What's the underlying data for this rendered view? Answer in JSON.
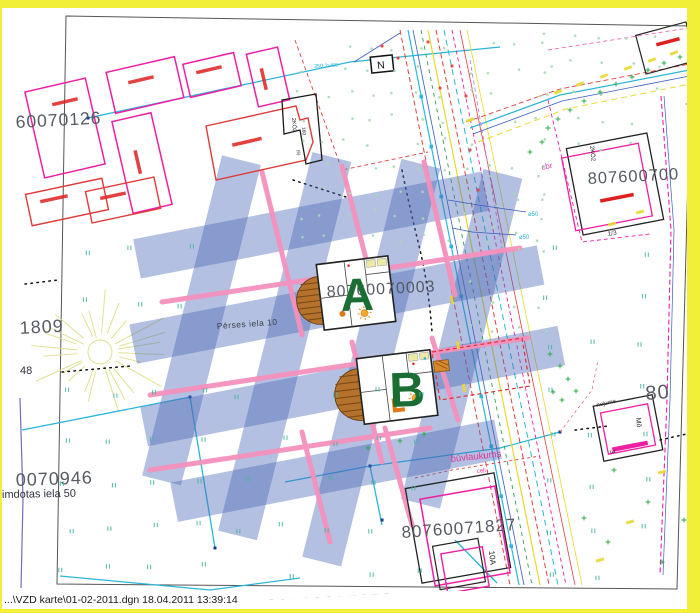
{
  "status_bar": {
    "file_info": "...\\VZD karte\\01-02-2011.dgn  18.04.2011 13:39:14"
  },
  "colors": {
    "border_yellow": "#f2ef39",
    "highlight_band_blue": "#4a6ab8",
    "highlight_pink": "#f591bd",
    "marker_green": "#1b6e33",
    "building_magenta": "#ef1fa4",
    "building_red": "#e03a3a",
    "boundary_cyan": "#2ab6d9",
    "number_gray": "#565a63"
  },
  "labels": {
    "p_nw": "60070126",
    "p_w": "1809",
    "p_w2": "48",
    "p_sw": "0070946",
    "street_sw": "imdotas iela 50",
    "street_center": "Pērses iela 10",
    "p_a": "80760070003",
    "marker_a": "A",
    "marker_b": "B",
    "p_ne": "807600700",
    "p_e": "80",
    "p_se": "80760071827",
    "p_s": "80760071828",
    "buvlaukums": "būvlaukums",
    "celi": "ceļi",
    "cbr": "cbr",
    "north": "N",
    "note_350": "350.2v/60",
    "d50_1": "ø50",
    "d50_2": "ø50",
    "b_2k02_nw": "2KŌ2",
    "b_160": "160",
    "b_6": "(6)",
    "b_2k02_ne": "2KŌ2",
    "b_13": "1/3",
    "b_mo": "Mō",
    "b_3": "3",
    "b_nojume": "nojume",
    "b_10a": "10A"
  }
}
